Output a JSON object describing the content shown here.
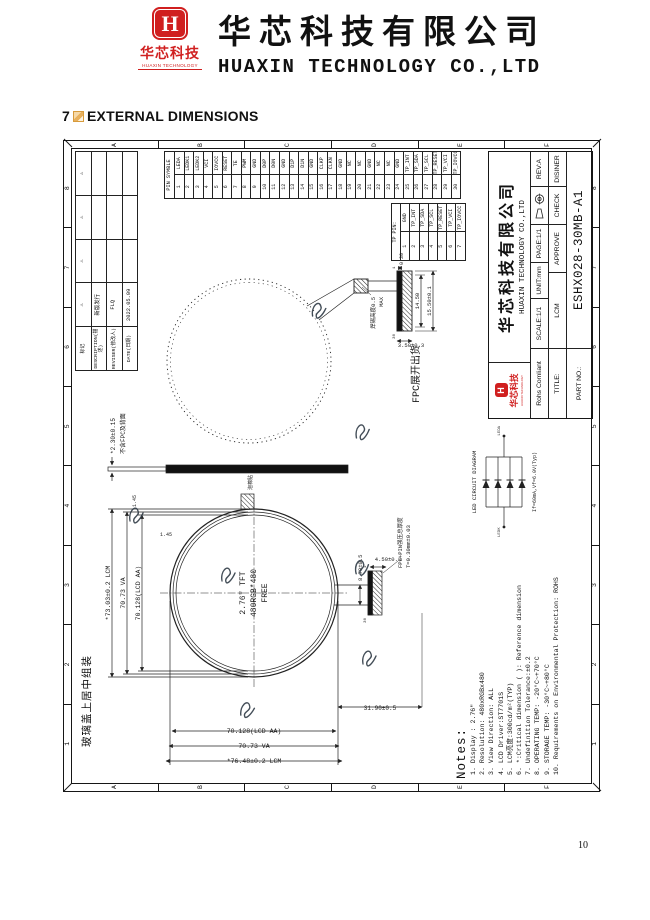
{
  "header": {
    "logo_symbol": "H",
    "logo_cn": "华芯科技",
    "logo_en": "HUAXIN TECHNOLOGY",
    "company_cn": "华芯科技有限公司",
    "company_en": "HUAXIN TECHNOLOGY CO.,LTD"
  },
  "section": {
    "number": "7",
    "title": "EXTERNAL DIMENSIONS"
  },
  "page_number": "10",
  "sheet": {
    "corner_note": "玻璃盖上居中组装",
    "frame": {
      "cols": [
        "1",
        "2",
        "3",
        "4",
        "5",
        "6",
        "7",
        "8"
      ],
      "rows": [
        "A",
        "B",
        "C",
        "D",
        "E",
        "F"
      ]
    },
    "revision": {
      "h_mark": "标记",
      "h_desc": "DESCRIPTION(描述)",
      "h_reviser": "REVISER(修改人)",
      "h_date": "DATE(日期)",
      "marks": [
        "⚠",
        "⚠",
        "⚠",
        "⚠"
      ],
      "desc": "新版发行",
      "reviser": "FLQ",
      "date": "2022.05.09"
    },
    "pin_table": {
      "header": "PIN SYMBLE",
      "pins": [
        {
          "n": "1",
          "name": "LEDA"
        },
        {
          "n": "2",
          "name": "LEDK1"
        },
        {
          "n": "3",
          "name": "LEDK2"
        },
        {
          "n": "4",
          "name": "VCI"
        },
        {
          "n": "5",
          "name": "IOVCC"
        },
        {
          "n": "6",
          "name": "RESET"
        },
        {
          "n": "7",
          "name": "TE"
        },
        {
          "n": "8",
          "name": "PWM"
        },
        {
          "n": "9",
          "name": "GND"
        },
        {
          "n": "10",
          "name": "D0P"
        },
        {
          "n": "11",
          "name": "D0N"
        },
        {
          "n": "12",
          "name": "GND"
        },
        {
          "n": "13",
          "name": "D1P"
        },
        {
          "n": "14",
          "name": "D1N"
        },
        {
          "n": "15",
          "name": "GND"
        },
        {
          "n": "16",
          "name": "CLKP"
        },
        {
          "n": "17",
          "name": "CLKN"
        },
        {
          "n": "18",
          "name": "GND"
        },
        {
          "n": "19",
          "name": "NC"
        },
        {
          "n": "20",
          "name": "NC"
        },
        {
          "n": "21",
          "name": "GND"
        },
        {
          "n": "22",
          "name": "NC"
        },
        {
          "n": "23",
          "name": "NC"
        },
        {
          "n": "24",
          "name": "GND"
        },
        {
          "n": "25",
          "name": "TP_INT"
        },
        {
          "n": "26",
          "name": "TP_SDA"
        },
        {
          "n": "27",
          "name": "TP_SCL"
        },
        {
          "n": "28",
          "name": "TP_RESET"
        },
        {
          "n": "29",
          "name": "TP_VCI"
        },
        {
          "n": "30",
          "name": "TP_IOVCC"
        }
      ]
    },
    "tp_table": {
      "header": "TP PIN:",
      "pins": [
        {
          "n": "1",
          "name": "GND"
        },
        {
          "n": "2",
          "name": "TP_INT"
        },
        {
          "n": "3",
          "name": "TP_SDA"
        },
        {
          "n": "4",
          "name": "TP_SCL"
        },
        {
          "n": "5",
          "name": "TP_RESET"
        },
        {
          "n": "6",
          "name": "TP_VCI"
        },
        {
          "n": "7",
          "name": "TP_IOVCC"
        }
      ]
    },
    "title_block": {
      "logo_symbol": "H",
      "logo_cn": "华芯科技",
      "logo_en": "HUAXIN TECHNOLOGY",
      "company_cn": "华芯科技有限公司",
      "company_en": "HUAXIN TECHNOLOGY CO.,LTD",
      "rohs": "Rohs Comliant",
      "scale": "SCALE:1/1",
      "unit": "UNIT:mm",
      "page": "PAGE:1/1",
      "rev": "REV:A",
      "title_label": "TITLE:",
      "title_value": "LCM",
      "approve": "APPROVE",
      "check": "CHECK",
      "designer": "DISINER",
      "part_label": "PART NO.:",
      "part_no": "ESHX028-30MB-A1"
    },
    "notes": {
      "title": "Notes:",
      "items": [
        "1. Display : 2.76\"",
        "2. Resolution: 480xRGBx480",
        "3. View Direction: ALL",
        "4. LCD Driver:ST7701S",
        "5. LCM亮度:300cd/m²(TYP)",
        "6. *:Critical dimension ( ): Reference dimension",
        "7. Undefinition Tolerance:±0.2",
        "8. OPERATING TEMP: -20°C~+70°C",
        "9. STORAGE TEMP: -30°C~+80°C",
        "10. Requirements on Environmental Protection: ROHS"
      ]
    },
    "front_view": {
      "label_line1": "2.76\" TFT",
      "label_line2": "480RGB*480",
      "label_line3": "FREE",
      "dim_w_lcm": "*73.03±0.2 LCM",
      "dim_w_va": "70.73 VA",
      "dim_w_aa": "70.128(LCD AA)",
      "dim_h_lcm": "*76.48±0.2 LCM",
      "dim_h_va": "70.73 VA",
      "dim_h_aa": "70.128(LCD AA)",
      "dim_edge_top": "1.45",
      "dim_edge_side": "1.45",
      "foam_label": "泡棉贴",
      "dim_tail_w": "8.70±0.5",
      "dim_tail_drop": "4.50±0.3",
      "dim_total": "31.90±0.5",
      "fpc_note1": "FPC+PIN强压总厚度",
      "fpc_note2": "T=0.30mm±0.03",
      "pin_first": "1",
      "pin_last": "30"
    },
    "side_view": {
      "dim": "*2.30±0.15",
      "note": "不含FPC及背面"
    },
    "fpc_view": {
      "label": "FPC展开出货",
      "solder1": "焊锡高度0.5",
      "solder2": "MAX",
      "dim_a": "0.30",
      "dim_b": "14.50",
      "dim_c": "15.50±0.1",
      "dim_d": "3.50±0.3",
      "pin_first": "1",
      "pin_last": "30"
    },
    "led": {
      "title": "LED CIRCUIT DIAGRAM",
      "left": "LEDK",
      "right": "LEDA",
      "note": "If=60mA,Vf=6.0V(Typ)"
    }
  }
}
